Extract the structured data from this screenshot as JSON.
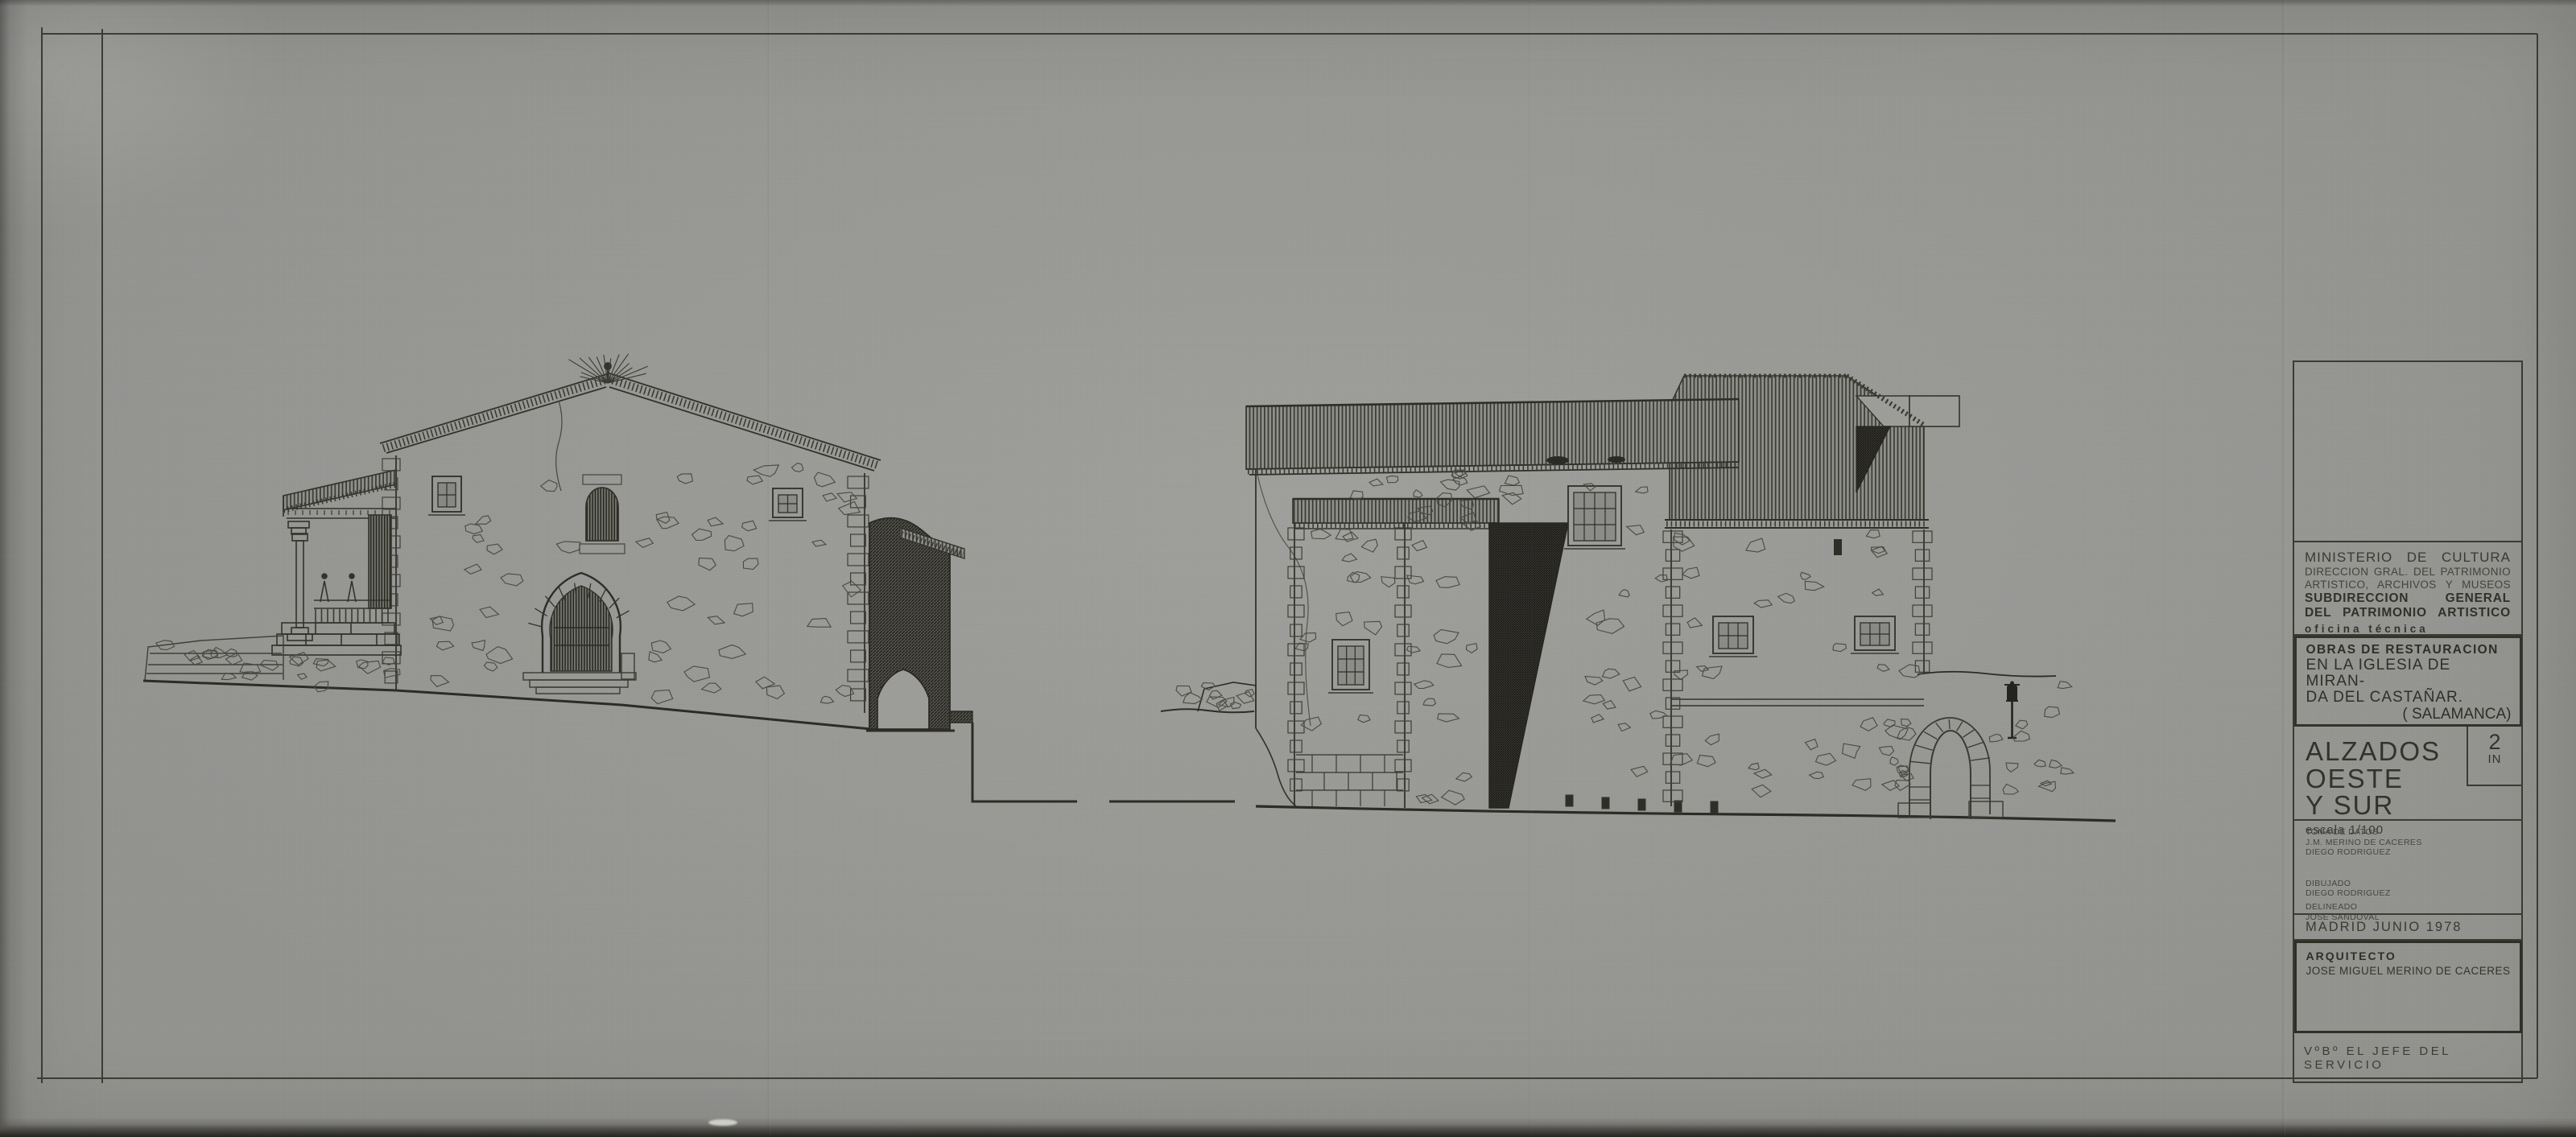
{
  "title_block": {
    "ministry": {
      "line1": "MINISTERIO DE CULTURA",
      "line2": "DIRECCION GRAL. DEL PATRIMONIO",
      "line3": "ARTISTICO, ARCHIVOS Y MUSEOS",
      "line4": "SUBDIRECCION GENERAL",
      "line5": "DEL PATRIMONIO ARTISTICO",
      "line6": "oficina técnica"
    },
    "project": {
      "line1": "OBRAS DE RESTAURACION",
      "line2": "EN LA IGLESIA DE MIRAN-",
      "line3": "DA DEL CASTAÑAR.",
      "line4": "( SALAMANCA)"
    },
    "drawing_title": {
      "line1": "ALZADOS OESTE",
      "line2": "Y SUR",
      "scale": "escala 1/100",
      "sheet_number": "2",
      "sheet_code": "IN"
    },
    "credits": {
      "role1": "TOMA DE DATOS",
      "name1a": "J.M. MERINO DE CACERES",
      "name1b": "DIEGO RODRIGUEZ",
      "role2": "DIBUJADO",
      "name2": "DIEGO RODRIGUEZ",
      "role3": "DELINEADO",
      "name3": "JOSE SANDOVAL"
    },
    "date": "MADRID JUNIO 1978",
    "architect": {
      "label": "ARQUITECTO",
      "name": "JOSE MIGUEL MERINO DE CACERES"
    },
    "approval": "VºBº EL JEFE DEL SERVICIO"
  },
  "colors": {
    "paper": "#9c9c99",
    "ink": "#33332c"
  }
}
